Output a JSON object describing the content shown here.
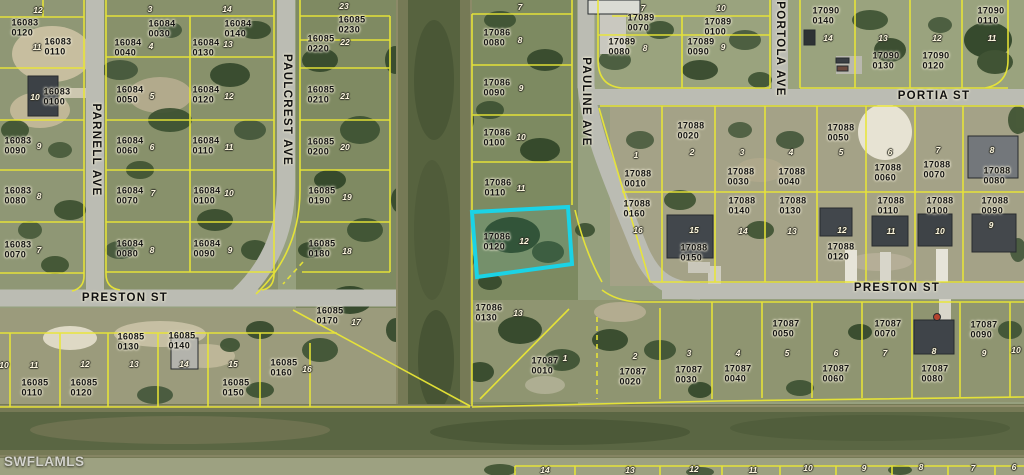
{
  "map": {
    "watermark": "SWFLAMLS",
    "highlight": {
      "parcel_id": "17086",
      "parcel_lot": "0120",
      "color": "#1bd3e6"
    },
    "colors": {
      "parcel_line": "#e9e636",
      "road": "#bbbcb3",
      "water": "#5a6743",
      "highlight": "#1bd3e6"
    },
    "street_labels": [
      {
        "label": "PARNELL AVE",
        "x": 96,
        "y": 150,
        "vertical": true
      },
      {
        "label": "PAULCREST AVE",
        "x": 287,
        "y": 110,
        "vertical": true
      },
      {
        "label": "PAULINE AVE",
        "x": 586,
        "y": 102,
        "vertical": true
      },
      {
        "label": "PORTOLA AVE",
        "x": 780,
        "y": 49,
        "vertical": true
      },
      {
        "label": "PORTIA ST",
        "x": 934,
        "y": 96,
        "vertical": false
      },
      {
        "label": "PRESTON ST",
        "x": 125,
        "y": 298,
        "vertical": false
      },
      {
        "label": "PRESTON ST",
        "x": 897,
        "y": 288,
        "vertical": false
      }
    ],
    "parcel_labels": [
      {
        "id": "16083",
        "lot": "0120",
        "x": 25,
        "y": 28
      },
      {
        "id": "16083",
        "lot": "0110",
        "x": 58,
        "y": 47
      },
      {
        "id": "16083",
        "lot": "0100",
        "x": 57,
        "y": 97
      },
      {
        "id": "16083",
        "lot": "0090",
        "x": 18,
        "y": 146
      },
      {
        "id": "16083",
        "lot": "0080",
        "x": 18,
        "y": 196
      },
      {
        "id": "16083",
        "lot": "0070",
        "x": 18,
        "y": 250
      },
      {
        "id": "16084",
        "lot": "0030",
        "x": 162,
        "y": 29
      },
      {
        "id": "16084",
        "lot": "0040",
        "x": 128,
        "y": 48
      },
      {
        "id": "16084",
        "lot": "0140",
        "x": 238,
        "y": 29
      },
      {
        "id": "16084",
        "lot": "0130",
        "x": 206,
        "y": 48
      },
      {
        "id": "16084",
        "lot": "0050",
        "x": 130,
        "y": 95
      },
      {
        "id": "16084",
        "lot": "0120",
        "x": 206,
        "y": 95
      },
      {
        "id": "16084",
        "lot": "0060",
        "x": 130,
        "y": 146
      },
      {
        "id": "16084",
        "lot": "0110",
        "x": 206,
        "y": 146
      },
      {
        "id": "16084",
        "lot": "0070",
        "x": 130,
        "y": 196
      },
      {
        "id": "16084",
        "lot": "0100",
        "x": 207,
        "y": 196
      },
      {
        "id": "16084",
        "lot": "0080",
        "x": 130,
        "y": 249
      },
      {
        "id": "16084",
        "lot": "0090",
        "x": 207,
        "y": 249
      },
      {
        "id": "16085",
        "lot": "0230",
        "x": 352,
        "y": 25
      },
      {
        "id": "16085",
        "lot": "0220",
        "x": 321,
        "y": 44
      },
      {
        "id": "16085",
        "lot": "0210",
        "x": 321,
        "y": 95
      },
      {
        "id": "16085",
        "lot": "0200",
        "x": 321,
        "y": 147
      },
      {
        "id": "16085",
        "lot": "0190",
        "x": 322,
        "y": 196
      },
      {
        "id": "16085",
        "lot": "0180",
        "x": 322,
        "y": 249
      },
      {
        "id": "16085",
        "lot": "0170",
        "x": 330,
        "y": 316
      },
      {
        "id": "16085",
        "lot": "0130",
        "x": 131,
        "y": 342
      },
      {
        "id": "16085",
        "lot": "0140",
        "x": 182,
        "y": 341
      },
      {
        "id": "16085",
        "lot": "0110",
        "x": 35,
        "y": 388
      },
      {
        "id": "16085",
        "lot": "0120",
        "x": 84,
        "y": 388
      },
      {
        "id": "16085",
        "lot": "0150",
        "x": 236,
        "y": 388
      },
      {
        "id": "16085",
        "lot": "0160",
        "x": 284,
        "y": 368
      },
      {
        "id": "17086",
        "lot": "0080",
        "x": 497,
        "y": 38
      },
      {
        "id": "17086",
        "lot": "0090",
        "x": 497,
        "y": 88
      },
      {
        "id": "17086",
        "lot": "0100",
        "x": 497,
        "y": 138
      },
      {
        "id": "17086",
        "lot": "0110",
        "x": 498,
        "y": 188
      },
      {
        "id": "17086",
        "lot": "0120",
        "x": 497,
        "y": 242
      },
      {
        "id": "17086",
        "lot": "0130",
        "x": 489,
        "y": 313
      },
      {
        "id": "17089",
        "lot": "0070",
        "x": 641,
        "y": 23
      },
      {
        "id": "17089",
        "lot": "0080",
        "x": 622,
        "y": 47
      },
      {
        "id": "17089",
        "lot": "0100",
        "x": 718,
        "y": 27
      },
      {
        "id": "17089",
        "lot": "0090",
        "x": 701,
        "y": 47
      },
      {
        "id": "17090",
        "lot": "0140",
        "x": 826,
        "y": 16
      },
      {
        "id": "17090",
        "lot": "0130",
        "x": 886,
        "y": 61
      },
      {
        "id": "17090",
        "lot": "0120",
        "x": 936,
        "y": 61
      },
      {
        "id": "17090",
        "lot": "0110",
        "x": 991,
        "y": 16
      },
      {
        "id": "17088",
        "lot": "0020",
        "x": 691,
        "y": 131
      },
      {
        "id": "17088",
        "lot": "0010",
        "x": 638,
        "y": 179
      },
      {
        "id": "17088",
        "lot": "0160",
        "x": 637,
        "y": 209
      },
      {
        "id": "17088",
        "lot": "0150",
        "x": 694,
        "y": 253
      },
      {
        "id": "17088",
        "lot": "0030",
        "x": 741,
        "y": 177
      },
      {
        "id": "17088",
        "lot": "0040",
        "x": 792,
        "y": 177
      },
      {
        "id": "17088",
        "lot": "0050",
        "x": 841,
        "y": 133
      },
      {
        "id": "17088",
        "lot": "0060",
        "x": 888,
        "y": 173
      },
      {
        "id": "17088",
        "lot": "0070",
        "x": 937,
        "y": 170
      },
      {
        "id": "17088",
        "lot": "0080",
        "x": 997,
        "y": 176
      },
      {
        "id": "17088",
        "lot": "0140",
        "x": 742,
        "y": 206
      },
      {
        "id": "17088",
        "lot": "0130",
        "x": 793,
        "y": 206
      },
      {
        "id": "17088",
        "lot": "0120",
        "x": 841,
        "y": 252
      },
      {
        "id": "17088",
        "lot": "0110",
        "x": 891,
        "y": 206
      },
      {
        "id": "17088",
        "lot": "0100",
        "x": 940,
        "y": 206
      },
      {
        "id": "17088",
        "lot": "0090",
        "x": 995,
        "y": 206
      },
      {
        "id": "17087",
        "lot": "0010",
        "x": 545,
        "y": 366
      },
      {
        "id": "17087",
        "lot": "0020",
        "x": 633,
        "y": 377
      },
      {
        "id": "17087",
        "lot": "0030",
        "x": 689,
        "y": 375
      },
      {
        "id": "17087",
        "lot": "0040",
        "x": 738,
        "y": 374
      },
      {
        "id": "17087",
        "lot": "0050",
        "x": 786,
        "y": 329
      },
      {
        "id": "17087",
        "lot": "0060",
        "x": 836,
        "y": 374
      },
      {
        "id": "17087",
        "lot": "0070",
        "x": 888,
        "y": 329
      },
      {
        "id": "17087",
        "lot": "0080",
        "x": 935,
        "y": 374
      },
      {
        "id": "17087",
        "lot": "0090",
        "x": 984,
        "y": 330
      }
    ],
    "lot_numbers": [
      {
        "n": "12",
        "x": 38,
        "y": 10
      },
      {
        "n": "11",
        "x": 37,
        "y": 47
      },
      {
        "n": "10",
        "x": 35,
        "y": 97
      },
      {
        "n": "9",
        "x": 39,
        "y": 146
      },
      {
        "n": "8",
        "x": 39,
        "y": 196
      },
      {
        "n": "7",
        "x": 39,
        "y": 250
      },
      {
        "n": "3",
        "x": 150,
        "y": 9
      },
      {
        "n": "4",
        "x": 151,
        "y": 46
      },
      {
        "n": "14",
        "x": 227,
        "y": 9
      },
      {
        "n": "13",
        "x": 228,
        "y": 44
      },
      {
        "n": "5",
        "x": 152,
        "y": 96
      },
      {
        "n": "12",
        "x": 229,
        "y": 96
      },
      {
        "n": "6",
        "x": 152,
        "y": 147
      },
      {
        "n": "11",
        "x": 229,
        "y": 147
      },
      {
        "n": "7",
        "x": 153,
        "y": 193
      },
      {
        "n": "10",
        "x": 229,
        "y": 193
      },
      {
        "n": "8",
        "x": 152,
        "y": 250
      },
      {
        "n": "9",
        "x": 230,
        "y": 250
      },
      {
        "n": "23",
        "x": 344,
        "y": 6
      },
      {
        "n": "22",
        "x": 345,
        "y": 42
      },
      {
        "n": "21",
        "x": 345,
        "y": 96
      },
      {
        "n": "20",
        "x": 345,
        "y": 147
      },
      {
        "n": "19",
        "x": 347,
        "y": 197
      },
      {
        "n": "18",
        "x": 347,
        "y": 251
      },
      {
        "n": "17",
        "x": 356,
        "y": 322
      },
      {
        "n": "10",
        "x": 4,
        "y": 365
      },
      {
        "n": "11",
        "x": 34,
        "y": 365
      },
      {
        "n": "12",
        "x": 85,
        "y": 364
      },
      {
        "n": "13",
        "x": 134,
        "y": 364
      },
      {
        "n": "14",
        "x": 184,
        "y": 364
      },
      {
        "n": "15",
        "x": 233,
        "y": 364
      },
      {
        "n": "16",
        "x": 307,
        "y": 369
      },
      {
        "n": "7",
        "x": 520,
        "y": 7
      },
      {
        "n": "8",
        "x": 520,
        "y": 40
      },
      {
        "n": "9",
        "x": 521,
        "y": 88
      },
      {
        "n": "10",
        "x": 521,
        "y": 137
      },
      {
        "n": "11",
        "x": 521,
        "y": 188
      },
      {
        "n": "12",
        "x": 524,
        "y": 241
      },
      {
        "n": "13",
        "x": 518,
        "y": 313
      },
      {
        "n": "7",
        "x": 643,
        "y": 8
      },
      {
        "n": "8",
        "x": 645,
        "y": 48
      },
      {
        "n": "10",
        "x": 721,
        "y": 8
      },
      {
        "n": "9",
        "x": 723,
        "y": 47
      },
      {
        "n": "14",
        "x": 828,
        "y": 38
      },
      {
        "n": "13",
        "x": 883,
        "y": 38
      },
      {
        "n": "12",
        "x": 937,
        "y": 38
      },
      {
        "n": "11",
        "x": 992,
        "y": 38
      },
      {
        "n": "1",
        "x": 636,
        "y": 155
      },
      {
        "n": "2",
        "x": 692,
        "y": 152
      },
      {
        "n": "16",
        "x": 638,
        "y": 230
      },
      {
        "n": "15",
        "x": 694,
        "y": 230
      },
      {
        "n": "3",
        "x": 742,
        "y": 152
      },
      {
        "n": "4",
        "x": 791,
        "y": 152
      },
      {
        "n": "5",
        "x": 841,
        "y": 152
      },
      {
        "n": "6",
        "x": 890,
        "y": 152
      },
      {
        "n": "7",
        "x": 938,
        "y": 150
      },
      {
        "n": "8",
        "x": 992,
        "y": 150
      },
      {
        "n": "14",
        "x": 743,
        "y": 231
      },
      {
        "n": "13",
        "x": 792,
        "y": 231
      },
      {
        "n": "12",
        "x": 842,
        "y": 230
      },
      {
        "n": "11",
        "x": 891,
        "y": 231
      },
      {
        "n": "10",
        "x": 940,
        "y": 231
      },
      {
        "n": "9",
        "x": 991,
        "y": 225
      },
      {
        "n": "1",
        "x": 565,
        "y": 358
      },
      {
        "n": "2",
        "x": 635,
        "y": 356
      },
      {
        "n": "3",
        "x": 689,
        "y": 353
      },
      {
        "n": "4",
        "x": 738,
        "y": 353
      },
      {
        "n": "5",
        "x": 787,
        "y": 353
      },
      {
        "n": "6",
        "x": 836,
        "y": 353
      },
      {
        "n": "7",
        "x": 885,
        "y": 353
      },
      {
        "n": "8",
        "x": 934,
        "y": 351
      },
      {
        "n": "9",
        "x": 984,
        "y": 353
      },
      {
        "n": "10",
        "x": 1016,
        "y": 350
      },
      {
        "n": "14",
        "x": 545,
        "y": 470
      },
      {
        "n": "13",
        "x": 630,
        "y": 470
      },
      {
        "n": "12",
        "x": 694,
        "y": 469
      },
      {
        "n": "11",
        "x": 753,
        "y": 470
      },
      {
        "n": "10",
        "x": 808,
        "y": 468
      },
      {
        "n": "9",
        "x": 864,
        "y": 468
      },
      {
        "n": "8",
        "x": 921,
        "y": 467
      },
      {
        "n": "7",
        "x": 973,
        "y": 468
      },
      {
        "n": "6",
        "x": 1014,
        "y": 467
      }
    ]
  }
}
